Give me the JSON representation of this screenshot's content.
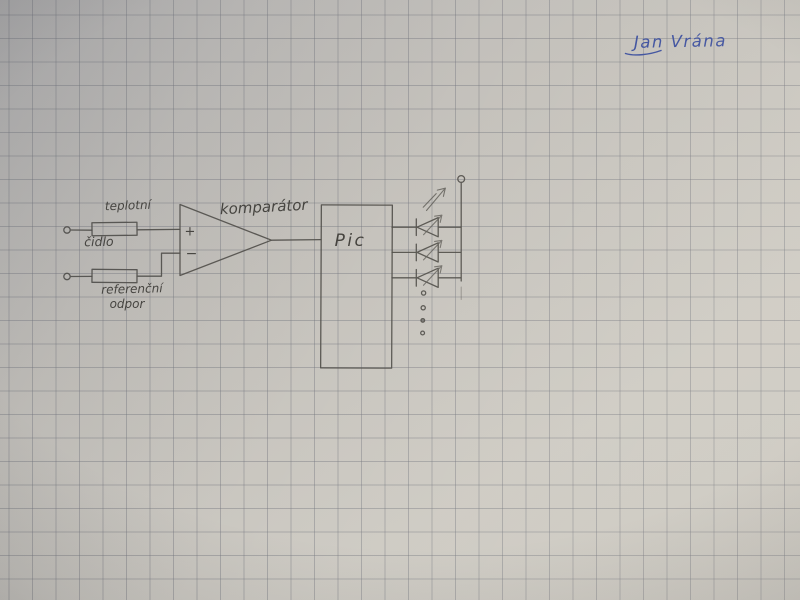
{
  "photo": {
    "signature": "Jan Vrána",
    "paper_color": "#c6c3bd",
    "grid_color": "#74767e",
    "grid_spacing_px": 23.5,
    "pencil_color": "#52504b",
    "ink_color": "#3d509e"
  },
  "schematic": {
    "sensor_label_top": "teplotní",
    "sensor_label_bottom": "čidlo",
    "reference_label_top": "referenční",
    "reference_label_bottom": "odpor",
    "comparator_label": "komparátor",
    "comparator_plus": "+",
    "comparator_minus": "−",
    "mcu_label": "Pic",
    "leds": {
      "count": 3,
      "ellipsis_dots": 4
    }
  }
}
